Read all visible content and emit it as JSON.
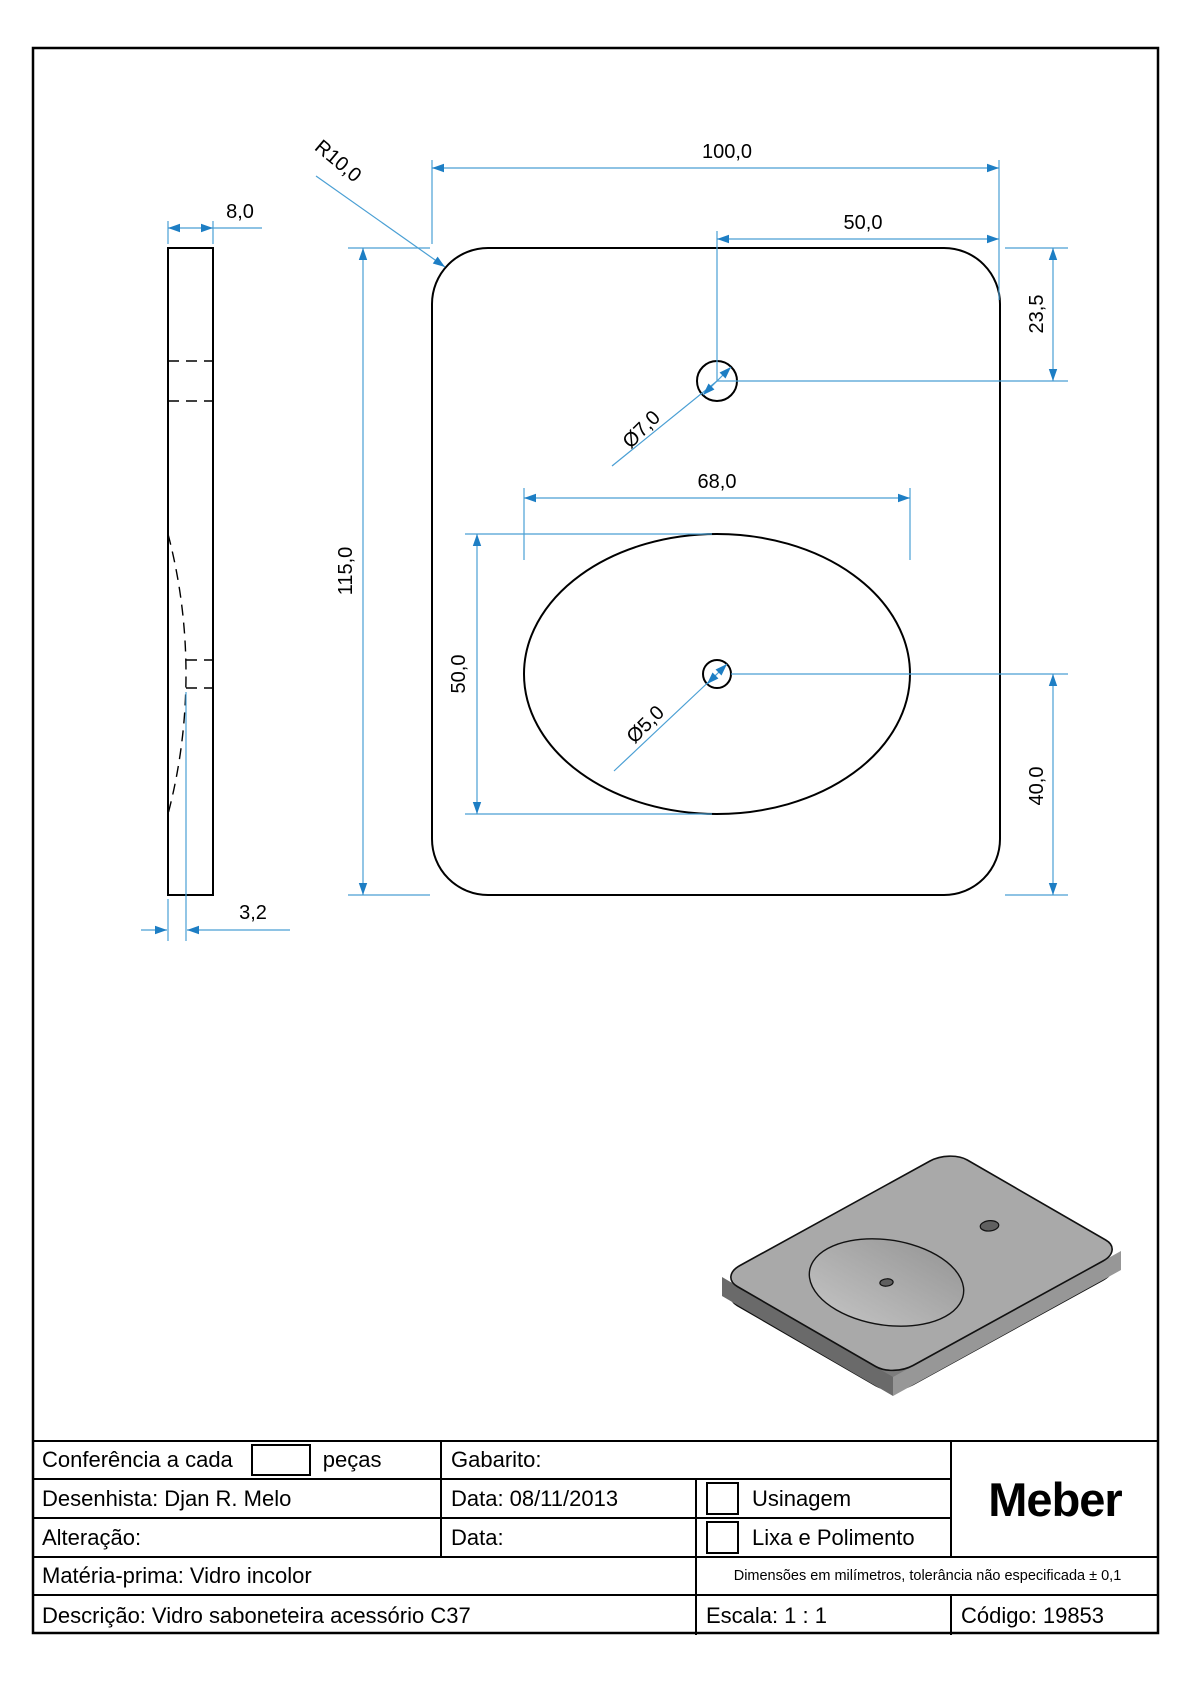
{
  "drawing": {
    "side_view": {
      "thickness": "8,0",
      "recess_depth": "3,2"
    },
    "front_view": {
      "width": "100,0",
      "hole_offset_right": "50,0",
      "height": "115,0",
      "corner_radius": "R10,0",
      "hole_from_top": "23,5",
      "hole_diameter": "Ø7,0",
      "recess_width": "68,0",
      "recess_height": "50,0",
      "center_hole_diameter": "Ø5,0",
      "center_hole_from_bottom": "40,0"
    }
  },
  "title_block": {
    "conference_label": "Conferência a cada",
    "conference_suffix": "peças",
    "gabarito_label": "Gabarito:",
    "designer_label": "Desenhista:",
    "designer_value": "Djan R. Melo",
    "date_label": "Data:",
    "date_value": "08/11/2013",
    "usinagem_label": "Usinagem",
    "alteration_label": "Alteração:",
    "date2_label": "Data:",
    "lixa_label": "Lixa e Polimento",
    "material_label": "Matéria-prima:",
    "material_value": "Vidro incolor",
    "tolerance_note": "Dimensões em milímetros, tolerância não especificada ± 0,1",
    "description_label": "Descrição:",
    "description_value": "Vidro saboneteira acessório C37",
    "scale_label": "Escala:",
    "scale_value": "1 : 1",
    "code_label": "Código:",
    "code_value": "19853",
    "logo": "Meber"
  },
  "colors": {
    "dimension_line": "#4a9fd4",
    "dimension_arrow": "#1d7ec4",
    "outline": "#000000",
    "iso_top": "#a9a9a9",
    "iso_side_dark": "#6a6a6a",
    "iso_side_light": "#979797",
    "iso_bottom": "#7d7d7d",
    "iso_hole": "#606060"
  }
}
